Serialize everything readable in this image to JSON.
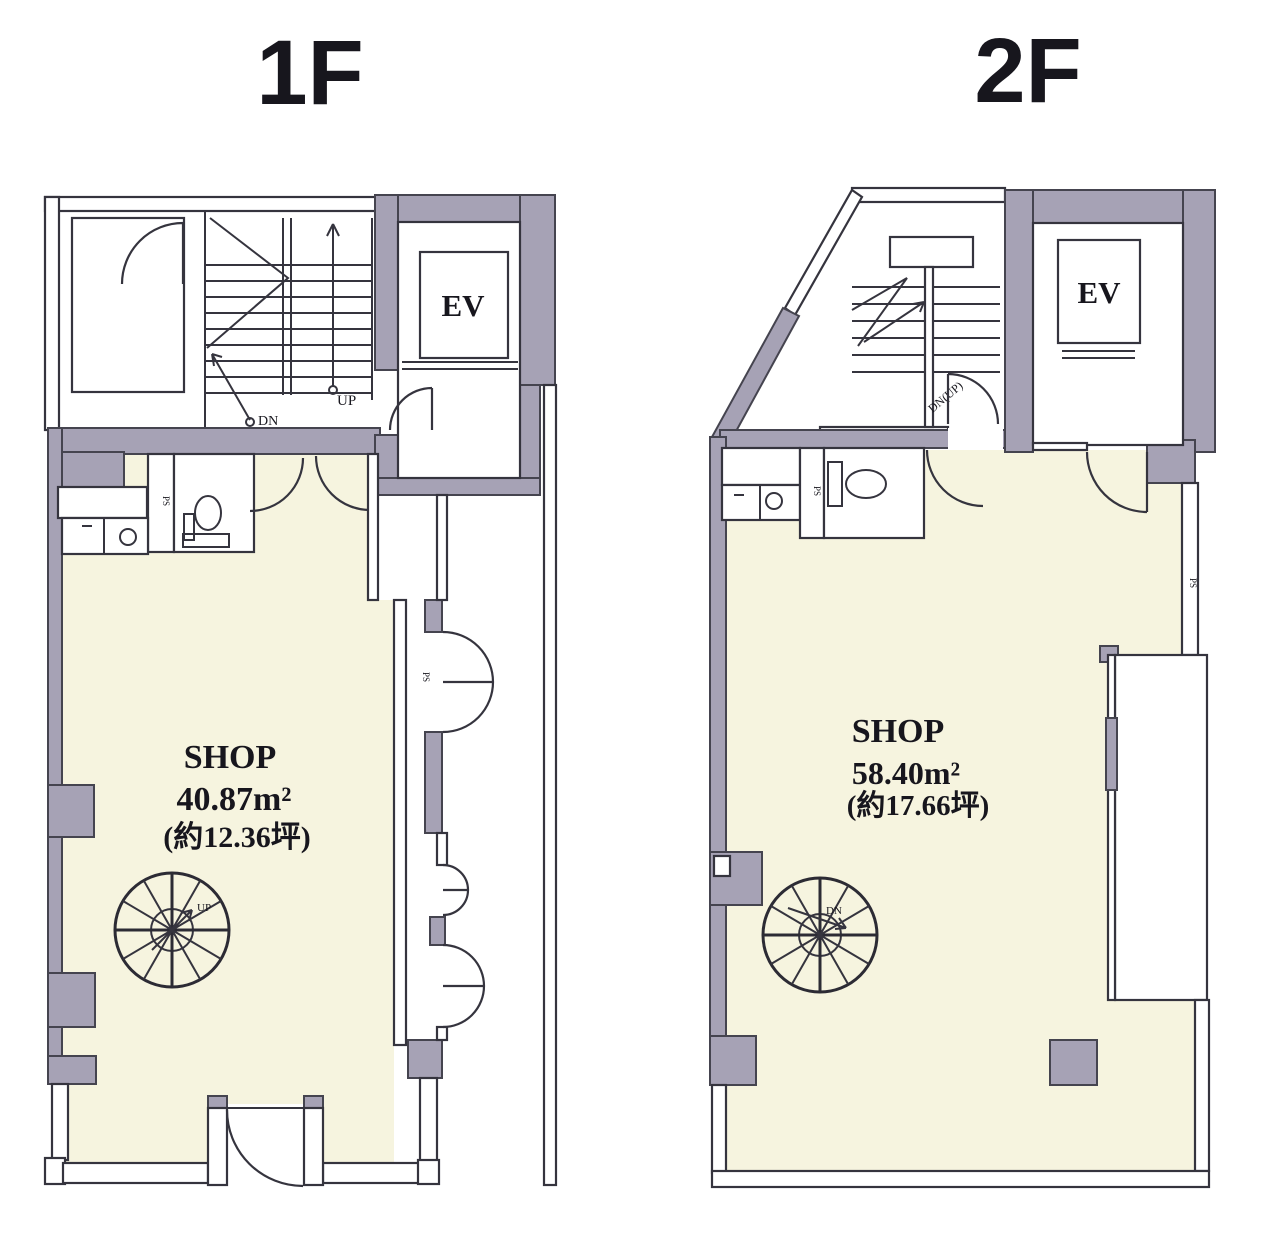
{
  "colors": {
    "wall_gray": "#a6a2b5",
    "wall_stroke": "#45444f",
    "floor_cream": "#f6f4df",
    "line": "#35343e",
    "text": "#17161d"
  },
  "floor1": {
    "title": "1F",
    "shop": "SHOP",
    "area": "40.87m²",
    "tsubo": "(約12.36坪)",
    "ev": "EV",
    "up": "UP",
    "dn": "DN",
    "spiral": "UP",
    "ps": "PS"
  },
  "floor2": {
    "title": "2F",
    "shop": "SHOP",
    "area": "58.40m²",
    "tsubo": "(約17.66坪)",
    "ev": "EV",
    "stair": "DN(UP)",
    "spiral": "DN",
    "ps": "PS"
  }
}
